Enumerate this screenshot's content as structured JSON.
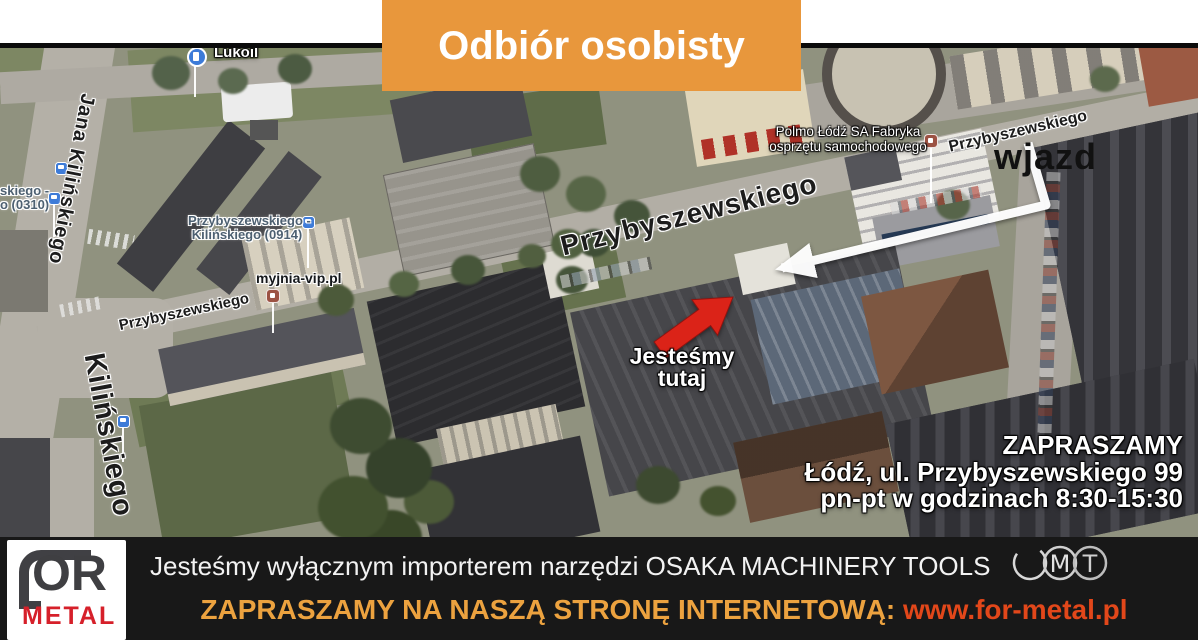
{
  "banner": {
    "title": "Odbiór osobisty"
  },
  "map_labels": {
    "jana_kilinskiego": "Jana Kilińskiego",
    "kilinskiego": "Kilińskiego",
    "przybyszewskiego_center": "Przybyszewskiego",
    "przybyszewskiego_topright": "Przybyszewskiego",
    "przybyszewskiego_left": "Przybyszewskiego",
    "lukoil": "Lukoil",
    "myjnia": "myjnia-vip.pl",
    "polmo_line1": "Polmo Łódź SA Fabryka",
    "polmo_line2": "osprzętu samochodowego",
    "stop_0914_line1": "Przybyszewskiego -",
    "stop_0914_line2": "Kilińskiego (0914)",
    "stop_0310_line1": "skiego -",
    "stop_0310_line2": "o (0310)"
  },
  "annotations": {
    "entrance": "wjazd",
    "here_line1": "Jesteśmy",
    "here_line2": "tutaj",
    "invite_title": "ZAPRASZAMY",
    "invite_address": "Łódź, ul. Przybyszewskiego 99",
    "invite_hours": "pn-pt w godzinach 8:30-15:30"
  },
  "footer": {
    "importer_text": "Jesteśmy wyłącznym importerem narzędzi OSAKA MACHINERY TOOLS",
    "omt_letters": [
      "O",
      "M",
      "T"
    ],
    "invite_label": "ZAPRASZAMY NA NASZĄ STRONĘ INTERNETOWĄ:",
    "website": "www.for-metal.pl",
    "logo_or": "OR",
    "logo_metal": "METAL"
  },
  "colors": {
    "banner_bg": "#E8973C",
    "footer_bg": "#181818",
    "footer_invite_label": "#ECA23F",
    "footer_url": "#E2471A",
    "logo_metal_red": "#D6202A",
    "here_arrow": "#DB2318",
    "route_arrow": "#FFFFFF",
    "transit_icon_blue": "#3D7BD8",
    "transit_label_blue": "#4D6071"
  }
}
